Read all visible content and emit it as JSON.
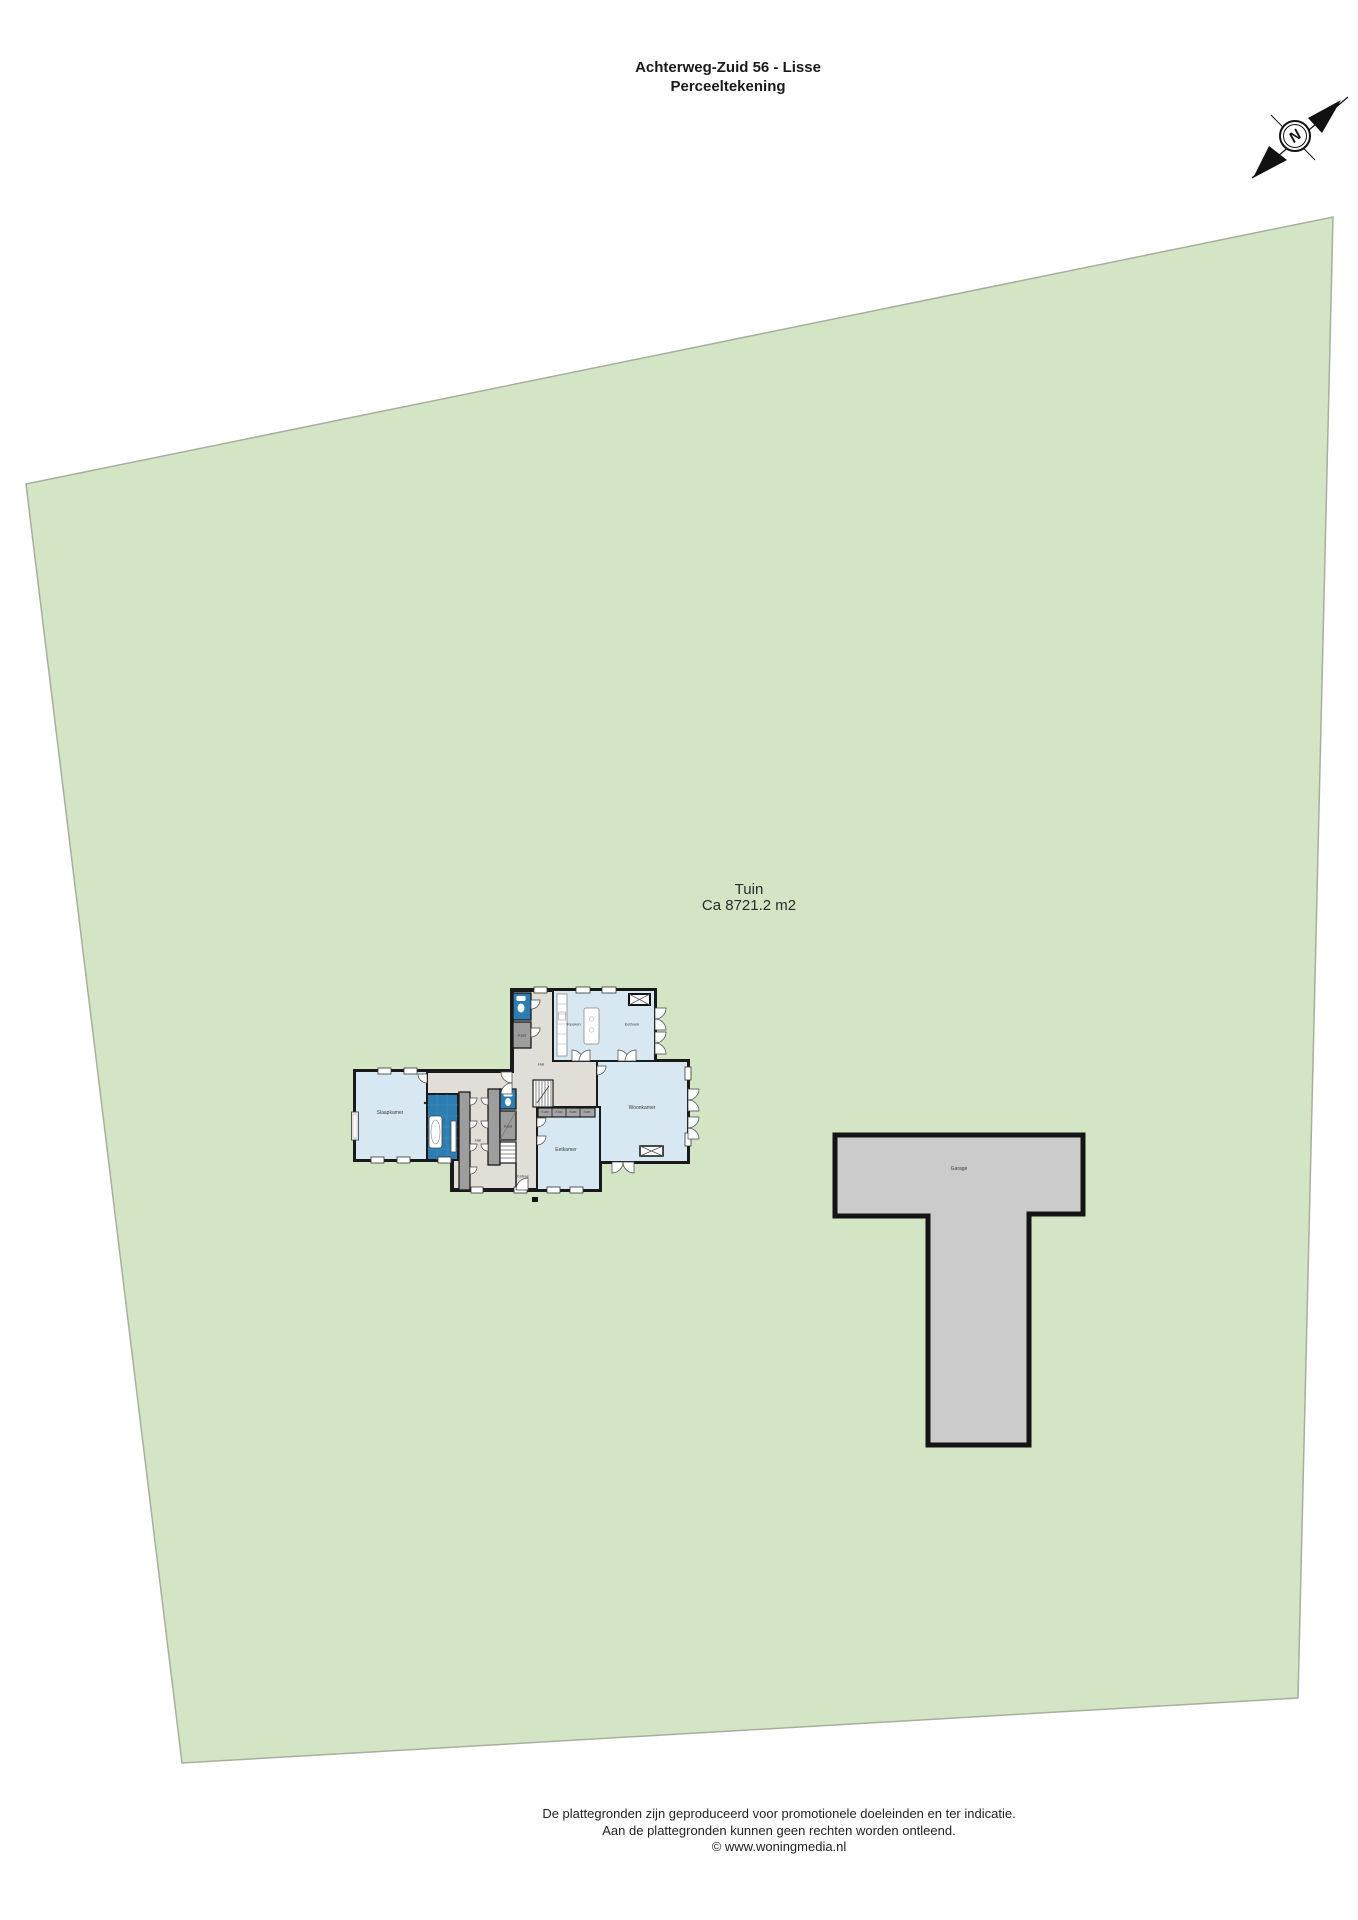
{
  "header": {
    "address": "Achterweg-Zuid 56 - Lisse",
    "subtitle": "Perceeltekening"
  },
  "compass": {
    "letter": "N"
  },
  "parcel": {
    "label": "Tuin",
    "area": "Ca 8721.2 m2"
  },
  "garage": {
    "label": "Garage"
  },
  "house": {
    "labels": {
      "keuken": "Keuken",
      "eethoek": "Eethoek",
      "woonkamer": "Woonkamer",
      "eetkamer": "Eetkamer",
      "slaapkamer": "Slaapkamer",
      "hal": "Hal",
      "entree": "Entree",
      "kast": "Kast"
    }
  },
  "footer": {
    "line1": "De plattegronden zijn geproduceerd voor promotionele doeleinden en ter indicatie.",
    "line2": "Aan de plattegronden kunnen geen rechten worden ontleend.",
    "line3": "© www.woningmedia.nl"
  },
  "colors": {
    "parcel_green": "#d4e5c6",
    "parcel_border": "#a8ae9e",
    "room_blue": "#d7e8f2",
    "sanitary_blue": "#2d7db3",
    "hall_beige": "#e1ded7",
    "closet_gray": "#9d9d9d",
    "garage_gray": "#cbcbcb",
    "wall_black": "#1a1a1a"
  }
}
